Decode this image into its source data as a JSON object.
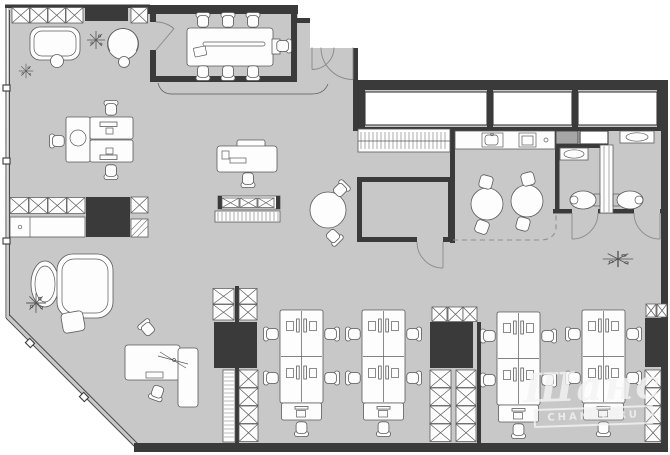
{
  "title": "Office floor plan",
  "watermark": {
    "script": "Шанс",
    "badge": "CHANCE.RU"
  },
  "colors": {
    "background": "#ffffff",
    "floor": "#c8c8c8",
    "wall": "#3a3a3a",
    "furniture_fill": "#fdfdfd",
    "furniture_line": "#5a5a5a",
    "shaft_gray": "#a6a6a6",
    "watermark": "#f4f4f4"
  },
  "rooms": [
    "meeting-room",
    "entry-vestibule",
    "reception-lounge",
    "open-office",
    "executive-zone",
    "kitchen",
    "coat-closet",
    "storage-room",
    "wc-left",
    "wc-right"
  ],
  "furniture_legend": [
    "conference-table",
    "office-chair",
    "sofa",
    "armchair",
    "ottoman",
    "plant",
    "desk",
    "bookcase",
    "wardrobe-cabinet",
    "kitchen-counter",
    "sink",
    "cooktop",
    "round-table",
    "stool",
    "wall-hung-toilet",
    "washbasin",
    "workstation-bench",
    "storage-column",
    "executive-desk",
    "coat-rack",
    "window"
  ]
}
